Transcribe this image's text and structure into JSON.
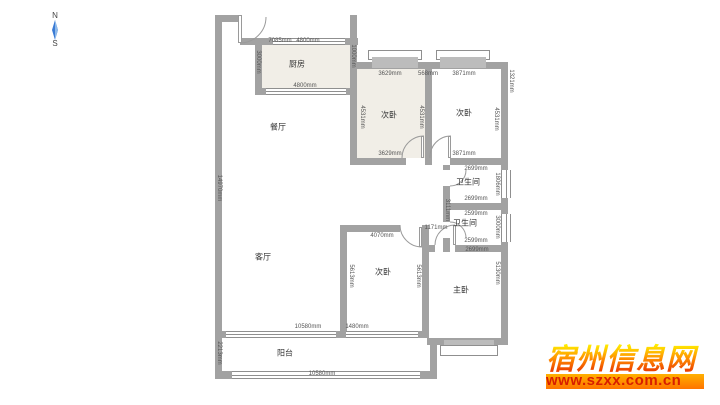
{
  "compass": {
    "north": "N",
    "south": "S"
  },
  "rooms": {
    "kitchen": "厨房",
    "dining": "餐厅",
    "living": "客厅",
    "bed_tl": "次卧",
    "bed_tr": "次卧",
    "bed_b": "次卧",
    "master": "主卧",
    "bath1": "卫生间",
    "bath2": "卫生间",
    "balcony": "阳台"
  },
  "dims": {
    "kitchen_w1": "7085mm",
    "kitchen_w2": "4800mm",
    "kitchen_bottom": "4800mm",
    "kitchen_left": "3000mm",
    "kitchen_right": "1000mm",
    "bed_tl_top": "3629mm",
    "gap_top": "568mm",
    "bed_tr_top": "3871mm",
    "bed_tl_left": "4531mm",
    "bed_tl_right": "4531mm",
    "bed_tr_right": "4531mm",
    "right_outside": "1321mm",
    "bed_tl_bottom": "3629mm",
    "bed_tr_bottom": "3871mm",
    "bath1_top": "2699mm",
    "bath1_bottom": "2699mm",
    "bath1_right": "1806mm",
    "bath2_top": "2599mm",
    "bath2_bottom": "2599mm",
    "bath2_right": "3000mm",
    "corridor_w": "1171mm",
    "corridor_h": "3111mm",
    "master_top": "2699mm",
    "master_right": "5130mm",
    "bed_b_top": "4070mm",
    "bed_b_left": "5613mm",
    "bed_b_right": "5613mm",
    "left_total": "14970mm",
    "living_bottom": "10580mm",
    "living_bottom2": "1480mm",
    "balcony_left": "2213mm",
    "balcony_bottom": "10580mm"
  },
  "watermark": {
    "title": "宿州信息网",
    "url": "www.szxx.com.cn"
  },
  "colors": {
    "wall": "#a2a2a2",
    "room_beige": "#f1eee7",
    "compass_blue": "#3a7bd5",
    "watermark_yellow": "#ffee00",
    "watermark_red": "#e83000",
    "url_text": "#d81e00"
  }
}
